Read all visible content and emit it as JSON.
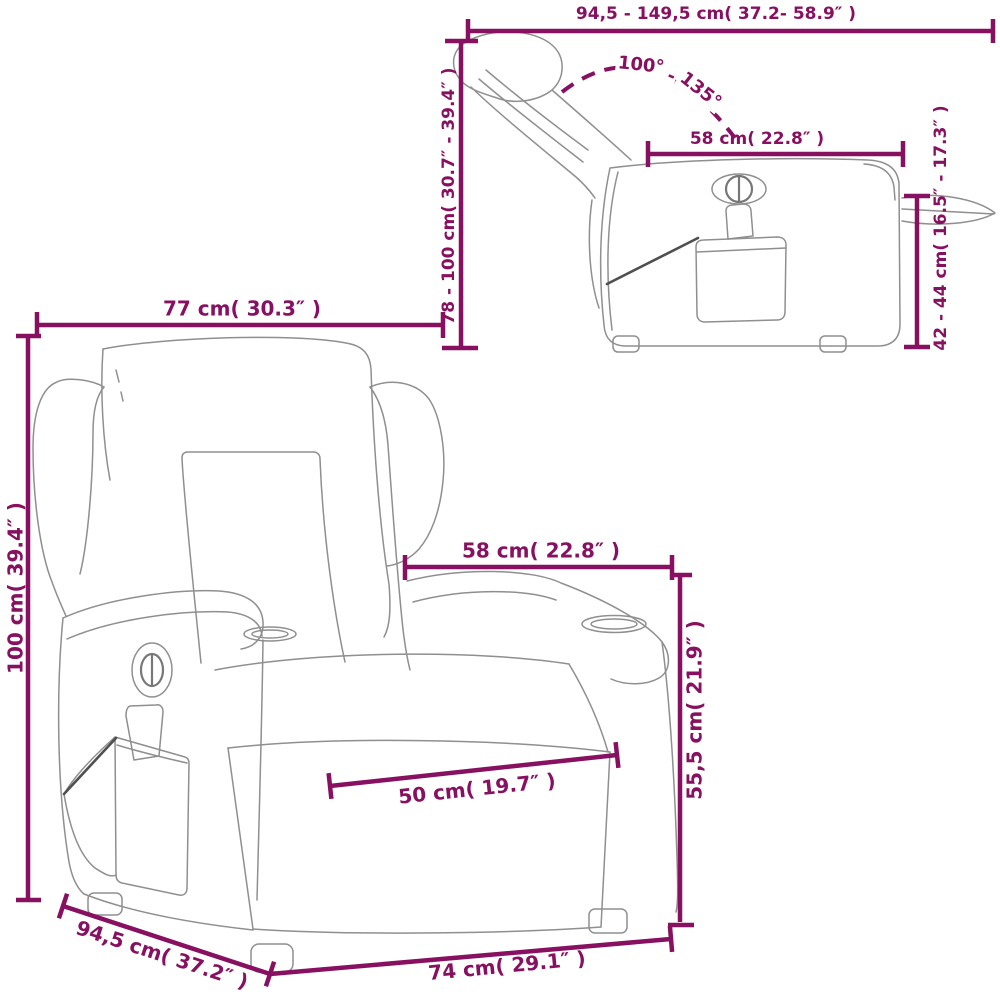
{
  "colors": {
    "dimension_accent": "#871160",
    "chair_outline": "#8f8f8f",
    "pocket_cord": "#4f4f4f",
    "background": "#ffffff"
  },
  "side_view": {
    "width_range_label": "94,5 - 149,5 cm( 37.2- 58.9″ )",
    "height_range_label": "78 - 100 cm( 30.7″ - 39.4″ )",
    "recline_angle_min_label": "100°",
    "recline_angle_separator": "-",
    "recline_angle_max_label": "135°",
    "armrest_length_label": "58 cm( 22.8″ )",
    "seat_height_range_label": "42 - 44 cm( 16.5″ - 17.3″ )"
  },
  "front_view": {
    "back_width_label": "77 cm( 30.3″ )",
    "height_label": "100 cm( 39.4″ )",
    "seat_width_label": "58 cm( 22.8″ )",
    "armrest_height_label": "55,5 cm( 21.9″ )",
    "seat_depth_label": "50 cm( 19.7″ )",
    "side_depth_label": "94,5 cm( 37.2″ )",
    "base_width_label": "74 cm( 29.1″ )"
  }
}
